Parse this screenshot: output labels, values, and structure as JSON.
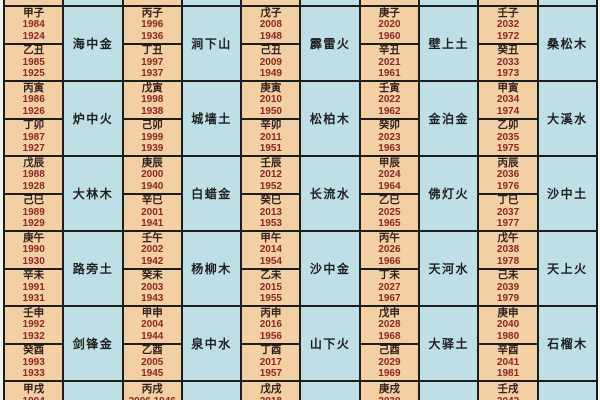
{
  "table": {
    "description_visible": "",
    "groups": [
      {
        "pairs": [
          {
            "years": [
              [
                "甲子",
                "1984",
                "1924"
              ],
              [
                "乙丑",
                "1985",
                "1925"
              ]
            ],
            "element": "海中金"
          },
          {
            "years": [
              [
                "丙子",
                "1996",
                "1936"
              ],
              [
                "丁丑",
                "1997",
                "1937"
              ]
            ],
            "element": "涧下山"
          },
          {
            "years": [
              [
                "戊子",
                "2008",
                "1948"
              ],
              [
                "己丑",
                "2009",
                "1949"
              ]
            ],
            "element": "霹雷火"
          },
          {
            "years": [
              [
                "庚子",
                "2020",
                "1960"
              ],
              [
                "辛丑",
                "2021",
                "1961"
              ]
            ],
            "element": "壁上土"
          },
          {
            "years": [
              [
                "壬子",
                "2032",
                "1972"
              ],
              [
                "癸丑",
                "2033",
                "1973"
              ]
            ],
            "element": "桑松木"
          }
        ]
      },
      {
        "pairs": [
          {
            "years": [
              [
                "丙寅",
                "1986",
                "1926"
              ],
              [
                "丁卯",
                "1987",
                "1927"
              ]
            ],
            "element": "炉中火"
          },
          {
            "years": [
              [
                "戊寅",
                "1998",
                "1938"
              ],
              [
                "己卯",
                "1999",
                "1939"
              ]
            ],
            "element": "城墙土"
          },
          {
            "years": [
              [
                "庚寅",
                "2010",
                "1950"
              ],
              [
                "辛卯",
                "2011",
                "1951"
              ]
            ],
            "element": "松柏木"
          },
          {
            "years": [
              [
                "壬寅",
                "2022",
                "1962"
              ],
              [
                "癸卯",
                "2023",
                "1963"
              ]
            ],
            "element": "金泊金"
          },
          {
            "years": [
              [
                "甲寅",
                "2034",
                "1974"
              ],
              [
                "乙卯",
                "2035",
                "1975"
              ]
            ],
            "element": "大溪水"
          }
        ]
      },
      {
        "pairs": [
          {
            "years": [
              [
                "戊辰",
                "1988",
                "1928"
              ],
              [
                "己巳",
                "1989",
                "1929"
              ]
            ],
            "element": "大林木"
          },
          {
            "years": [
              [
                "庚辰",
                "2000",
                "1940"
              ],
              [
                "辛巳",
                "2001",
                "1941"
              ]
            ],
            "element": "白蜡金"
          },
          {
            "years": [
              [
                "壬辰",
                "2012",
                "1952"
              ],
              [
                "癸巳",
                "2013",
                "1953"
              ]
            ],
            "element": "长流水"
          },
          {
            "years": [
              [
                "甲辰",
                "2024",
                "1964"
              ],
              [
                "乙巳",
                "2025",
                "1965"
              ]
            ],
            "element": "佛灯火"
          },
          {
            "years": [
              [
                "丙辰",
                "2036",
                "1976"
              ],
              [
                "丁巳",
                "2037",
                "1977"
              ]
            ],
            "element": "沙中土"
          }
        ]
      },
      {
        "pairs": [
          {
            "years": [
              [
                "庚午",
                "1990",
                "1930"
              ],
              [
                "辛未",
                "1991",
                "1931"
              ]
            ],
            "element": "路旁土"
          },
          {
            "years": [
              [
                "壬午",
                "2002",
                "1942"
              ],
              [
                "癸未",
                "2003",
                "1943"
              ]
            ],
            "element": "杨柳木"
          },
          {
            "years": [
              [
                "甲午",
                "2014",
                "1954"
              ],
              [
                "乙未",
                "2015",
                "1955"
              ]
            ],
            "element": "沙中金"
          },
          {
            "years": [
              [
                "丙午",
                "2026",
                "1966"
              ],
              [
                "丁未",
                "2027",
                "1967"
              ]
            ],
            "element": "天河水"
          },
          {
            "years": [
              [
                "戊午",
                "2038",
                "1978"
              ],
              [
                "己未",
                "2039",
                "1979"
              ]
            ],
            "element": "天上火"
          }
        ]
      },
      {
        "pairs": [
          {
            "years": [
              [
                "壬申",
                "1992",
                "1932"
              ],
              [
                "癸酉",
                "1993",
                "1933"
              ]
            ],
            "element": "剑锋金"
          },
          {
            "years": [
              [
                "甲申",
                "2004",
                "1944"
              ],
              [
                "乙酉",
                "2005",
                "1945"
              ]
            ],
            "element": "泉中水"
          },
          {
            "years": [
              [
                "丙申",
                "2016",
                "1956"
              ],
              [
                "丁酉",
                "2017",
                "1957"
              ]
            ],
            "element": "山下火"
          },
          {
            "years": [
              [
                "戊申",
                "2028",
                "1968"
              ],
              [
                "己酉",
                "2029",
                "1969"
              ]
            ],
            "element": "大驿土"
          },
          {
            "years": [
              [
                "庚申",
                "2040",
                "1980"
              ],
              [
                "辛酉",
                "2041",
                "1981"
              ]
            ],
            "element": "石榴木"
          }
        ]
      }
    ],
    "partial_bottom": [
      {
        "sb": "甲戌",
        "year": "1994"
      },
      {
        "sb": "丙戌",
        "year": "2006 1946"
      },
      {
        "sb": "戊戌",
        "year": "2018"
      },
      {
        "sb": "庚戌",
        "year": "2030"
      },
      {
        "sb": "壬戌",
        "year": "2042"
      }
    ],
    "colors": {
      "year_col_bg": "#f3cfa4",
      "element_col_bg": "#bedfe6",
      "border": "#1c1c1c",
      "stem_branch_text": "#33201e",
      "year_text": "#8a2724",
      "element_text": "#1f1f1f"
    }
  }
}
